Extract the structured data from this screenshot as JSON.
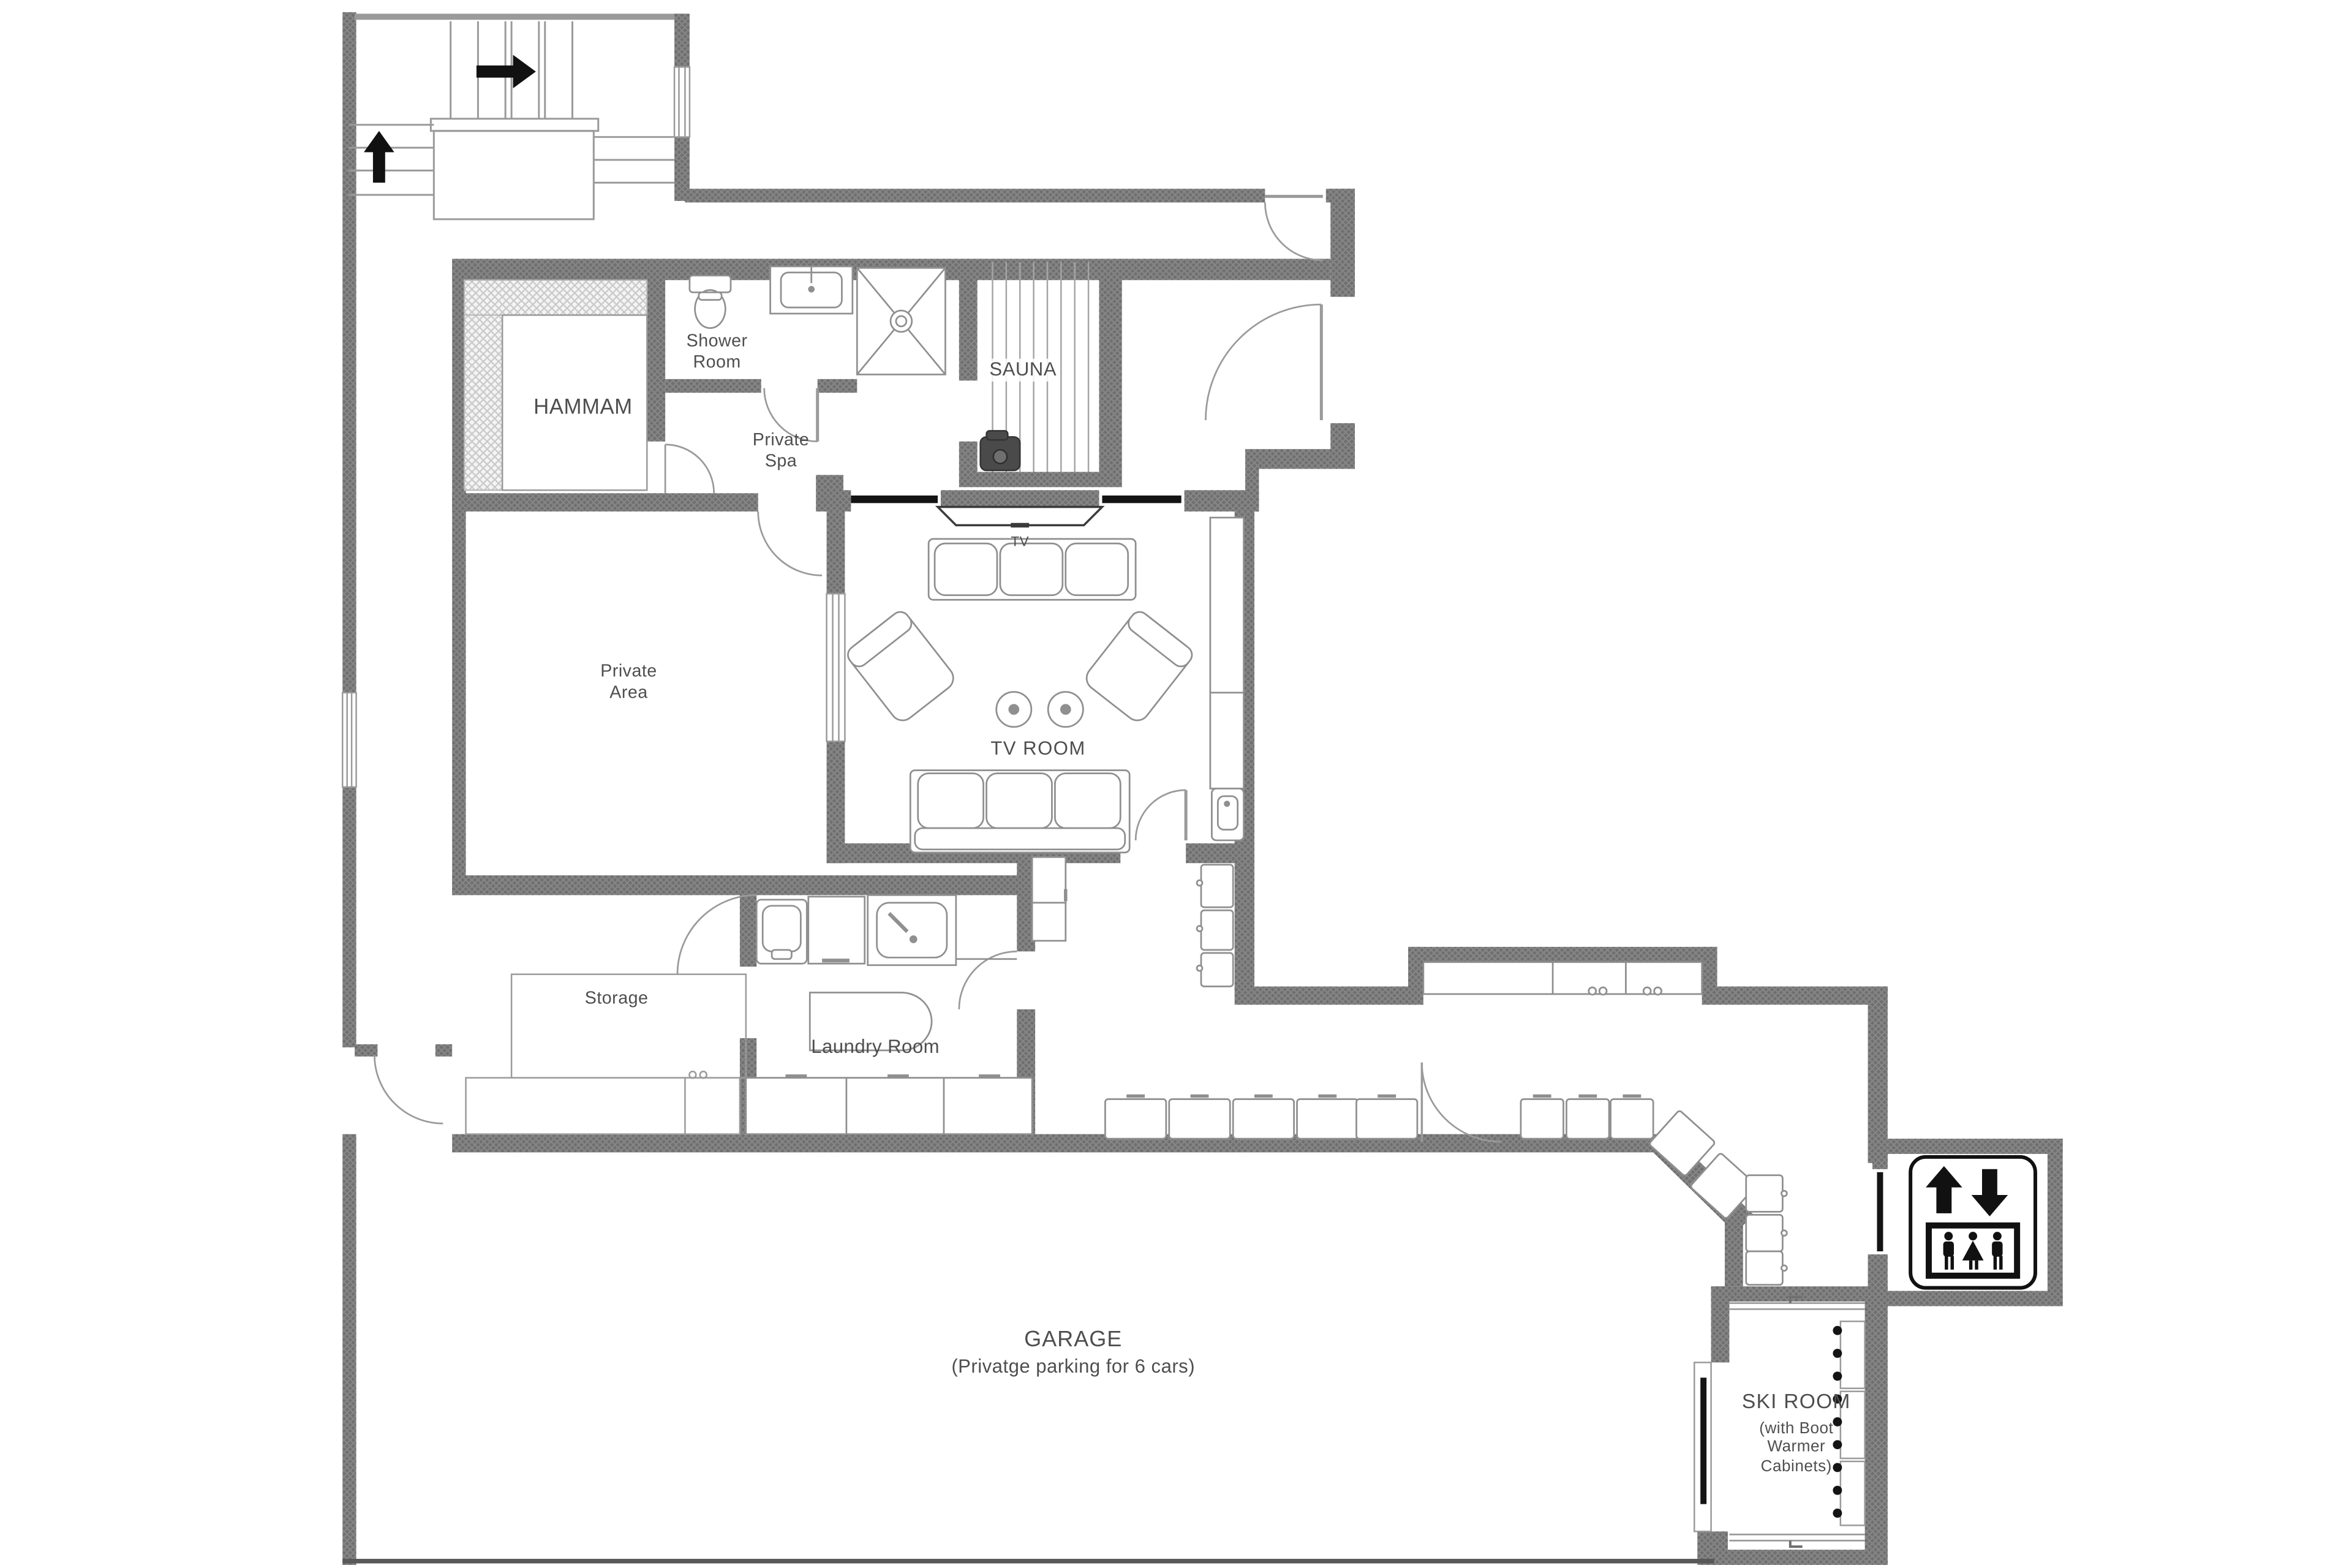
{
  "document": {
    "type": "floor-plan",
    "level": "basement"
  },
  "labels": {
    "hammam": "HAMMAM",
    "shower_room": "Shower\nRoom",
    "sauna": "SAUNA",
    "private_spa": "Private\nSpa",
    "private_area": "Private\nArea",
    "tv_room": "TV ROOM",
    "tv": "TV",
    "storage": "Storage",
    "laundry_room": "Laundry Room",
    "garage": "GARAGE",
    "garage_note": "(Privatge parking for 6 cars)",
    "ski_room": "SKI ROOM",
    "ski_room_note": "(with Boot\nWarmer\nCabinets)"
  },
  "icons": {
    "elevator": "elevator-updown-people-icon",
    "stair_up": "stairs-up-arrow-icon",
    "stair_right": "stairs-right-arrow-icon"
  },
  "colors": {
    "wall": "#6f6f6f",
    "wall_hatch": "#868686",
    "thin_line": "#8f8f8f",
    "fixture_line": "#909090",
    "text": "#4e4e4e",
    "black": "#111111",
    "hammam_hatch": "#c9c9c9",
    "background": "#ffffff"
  }
}
